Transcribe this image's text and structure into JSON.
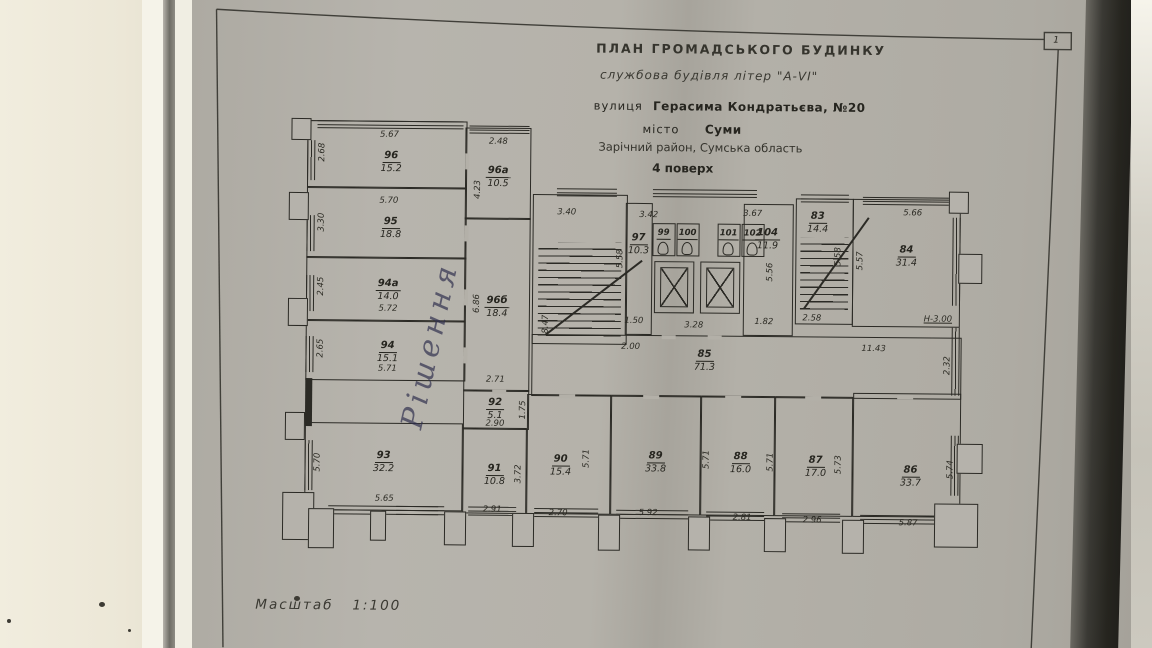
{
  "photo": {
    "page_corner_number": "1",
    "handwritten_note": "Рішення"
  },
  "title_block": {
    "line1": "ПЛАН  ГРОМАДСЬКОГО  БУДИНКУ",
    "line2": "службова будівля літер \"А-VI\"",
    "line3_prefix": "вулиця",
    "line3_value": "Герасима Кондратьєва, №20",
    "line4_prefix": "місто",
    "line4_value": "Суми",
    "line5": "Зарічний район, Сумська область",
    "line6": "4 поверх"
  },
  "scale": {
    "label": "Масштаб",
    "value": "1:100"
  },
  "rooms": [
    {
      "num": "96",
      "area": "15.2"
    },
    {
      "num": "96а",
      "area": "10.5"
    },
    {
      "num": "95",
      "area": "18.8"
    },
    {
      "num": "94а",
      "area": "14.0"
    },
    {
      "num": "94",
      "area": "15.1"
    },
    {
      "num": "96б",
      "area": "18.4"
    },
    {
      "num": "92",
      "area": "5.1"
    },
    {
      "num": "93",
      "area": "32.2"
    },
    {
      "num": "91",
      "area": "10.8"
    },
    {
      "num": "90",
      "area": "15.4"
    },
    {
      "num": "97",
      "area": "10.3"
    },
    {
      "num": "99",
      "area": ""
    },
    {
      "num": "100",
      "area": ""
    },
    {
      "num": "101",
      "area": ""
    },
    {
      "num": "102",
      "area": ""
    },
    {
      "num": "104",
      "area": "11.9"
    },
    {
      "num": "83",
      "area": "14.4"
    },
    {
      "num": "84",
      "area": "31.4"
    },
    {
      "num": "85",
      "area": "71.3"
    },
    {
      "num": "89",
      "area": "33.8"
    },
    {
      "num": "88",
      "area": "16.0"
    },
    {
      "num": "87",
      "area": "17.0"
    },
    {
      "num": "86",
      "area": "33.7"
    }
  ],
  "dims": {
    "t567": "5.67",
    "t268": "2.68",
    "t570": "5.70",
    "t330": "3.30",
    "t245": "2.45",
    "t572": "5.72",
    "t265": "2.65",
    "t571": "5.71",
    "t570b": "5.70",
    "t565": "5.65",
    "t248": "2.48",
    "t423": "4.23",
    "t686": "6.86",
    "t271": "2.71",
    "t175": "1.75",
    "t290": "2.90",
    "t372": "3.72",
    "t291": "2.91",
    "t270": "2.70",
    "t340": "3.40",
    "t847": "8.47",
    "t558": "5.58",
    "t342": "3.42",
    "t367": "3.67",
    "t150": "1.50",
    "t200": "2.00",
    "t328": "3.28",
    "t182": "1.82",
    "t556": "5.56",
    "t558b": "5.58",
    "t258": "2.58",
    "t557": "5.57",
    "t566": "5.66",
    "th300": "Н-3.00",
    "t1143": "11.43",
    "t232": "2.32",
    "t571a": "5.71",
    "t571b": "5.71",
    "t571c": "5.71",
    "t573": "5.73",
    "t574": "5.74",
    "t592": "5.92",
    "t281": "2.81",
    "t296": "2.96",
    "t587": "5.87"
  }
}
